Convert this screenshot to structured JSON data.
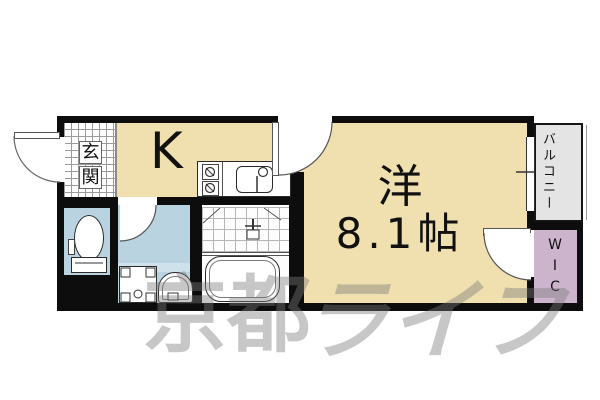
{
  "floorplan": {
    "rooms": {
      "entrance": {
        "label": "玄関",
        "label_chars": [
          "玄",
          "関"
        ]
      },
      "kitchen": {
        "label": "K"
      },
      "main_room": {
        "name_label": "洋",
        "size_label": "8.1帖"
      },
      "balcony": {
        "label": "バルコニー"
      },
      "wic": {
        "label": "WIC"
      }
    },
    "watermark": {
      "text": "京都ライフ",
      "left_part": "京都",
      "right_part": "ライフ"
    },
    "icons": [
      "toilet-icon",
      "washing-machine-pan-icon",
      "washbasin-icon",
      "bathtub-icon",
      "stove-icon",
      "kitchen-sink-icon",
      "door-swing-icon",
      "sliding-window-icon"
    ],
    "colors": {
      "room_fill": "#f0e0b0",
      "wet_area_fill": "#b9d3e1",
      "wet_area_light": "#cfe2ec",
      "wic_fill": "#cdb4cd",
      "balcony_fill": "#e4e4e4",
      "wall": "#0d0d0d",
      "watermark": "#7a7a7a"
    }
  }
}
